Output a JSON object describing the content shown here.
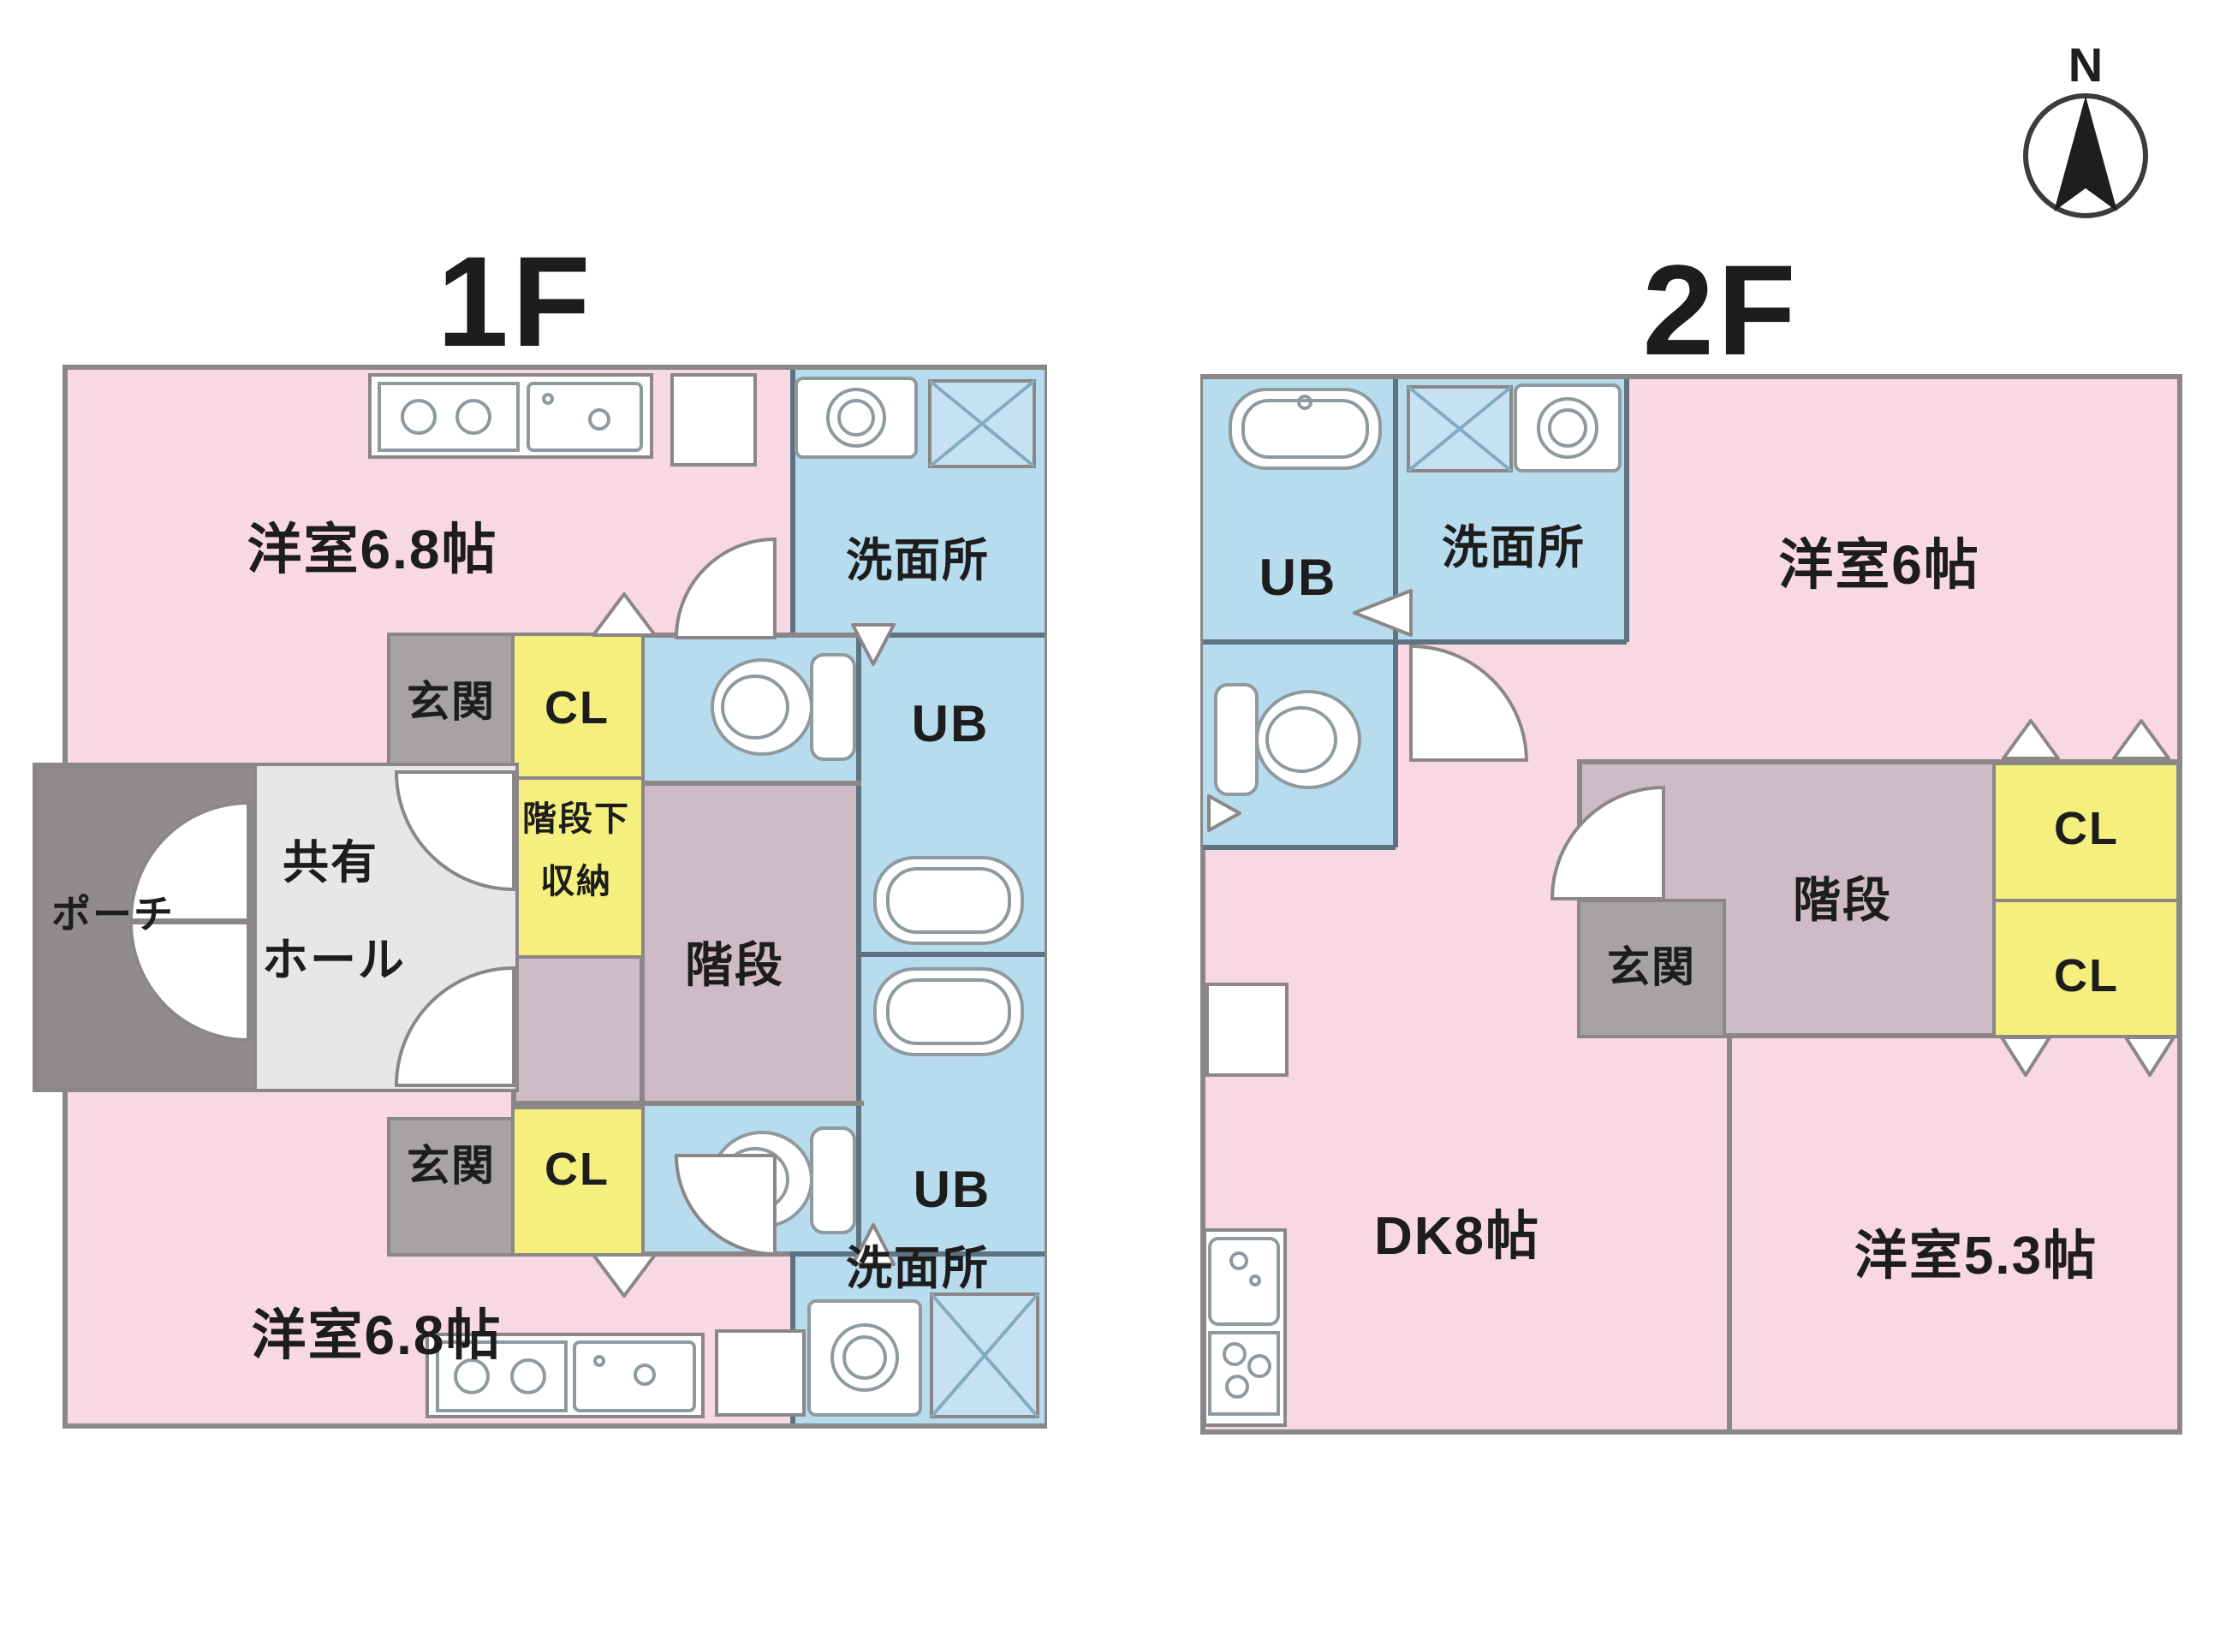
{
  "palette": {
    "pink": "#f8d8e2",
    "blue": "#b7dcee",
    "yellow": "#f5ef7e",
    "mauve": "#cfbbc5",
    "gray": "#a7a3a5",
    "hall": "#e7e6e8",
    "porch": "#908c8e",
    "wall": "#8b8789",
    "bluewall": "#5e737f",
    "text": "#1d1d1d",
    "xfill": "#c6e2f2",
    "xline": "#84aac1",
    "fixline": "#8f9a9f"
  },
  "compass": {
    "north": "N"
  },
  "floor1": {
    "title": "1F",
    "rooms": {
      "room_top": "洋室6.8帖",
      "room_bottom": "洋室6.8帖",
      "wash_top": "洗面所",
      "wash_bottom": "洗面所",
      "ub_top": "UB",
      "ub_bottom": "UB",
      "genkan_top": "玄関",
      "genkan_bottom": "玄関",
      "cl_top": "CL",
      "cl_bottom": "CL",
      "understairs_line1": "階段下",
      "understairs_line2": "収納",
      "stairs": "階段",
      "hall_line1": "共有",
      "hall_line2": "ホール",
      "porch": "ポーチ"
    }
  },
  "floor2": {
    "title": "2F",
    "rooms": {
      "ub": "UB",
      "wash": "洗面所",
      "room6": "洋室6帖",
      "cl_upper": "CL",
      "cl_lower": "CL",
      "stairs": "階段",
      "genkan": "玄関",
      "dk": "DK8帖",
      "room53": "洋室5.3帖"
    }
  }
}
